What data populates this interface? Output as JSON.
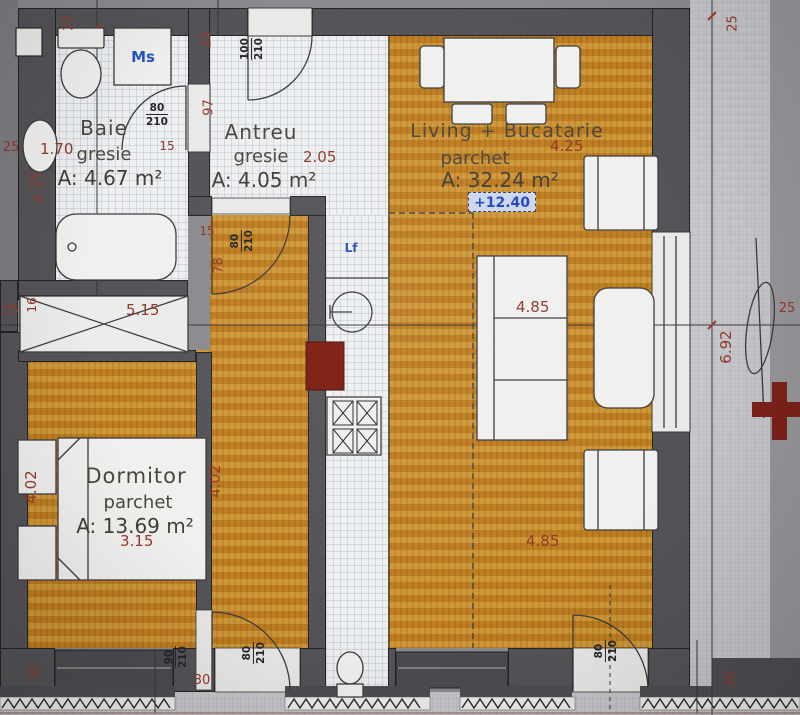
{
  "rooms": {
    "baie": {
      "name": "Baie",
      "finish": "gresie",
      "area": "A: 4.67 m²"
    },
    "antreu": {
      "name": "Antreu",
      "finish": "gresie",
      "area": "A: 4.05 m²"
    },
    "living": {
      "name": "Living + Bucatarie",
      "finish": "parchet",
      "area": "A: 32.24 m²",
      "level_mark": "+12.40"
    },
    "dormitor": {
      "name": "Dormitor",
      "finish": "parchet",
      "area": "A: 13.69 m²"
    }
  },
  "appliances": {
    "washing_machine_label": "Ms",
    "fridge_label": "Lf"
  },
  "dimensions": {
    "bath_width": "1.70",
    "bath_depth": "2.75",
    "closet_width": "5.15",
    "antreu_width": "2.05",
    "living_width": "4.25",
    "living_mid_width": "4.85",
    "living_lower_width": "4.85",
    "living_depth": "6.92",
    "bedroom_width": "3.15",
    "bedroom_depth": "4.02",
    "corridor_depth": "4.02"
  },
  "wall_marks": {
    "thickness_25": "25",
    "thickness_30": "30",
    "thickness_15": "15",
    "thickness_16": "16",
    "opening_97": "97",
    "opening_78": "78"
  },
  "doors": {
    "bathroom": {
      "width": "80",
      "height": "210"
    },
    "entry": {
      "width": "100",
      "height": "210"
    },
    "hallway": {
      "width": "80",
      "height": "210"
    },
    "bedroom": {
      "width": "90",
      "height": "210"
    },
    "corridor_balcony": {
      "width": "80",
      "height": "210"
    },
    "living_balcony": {
      "width": "80",
      "height": "210"
    }
  },
  "colors": {
    "dimension_red": "#93392a",
    "label_blue": "#2553c2",
    "wall_gray": "#545458",
    "parquet_tan": "#dfb963",
    "tile_gray": "#edeff1",
    "shaft_red": "#7c1d10"
  }
}
